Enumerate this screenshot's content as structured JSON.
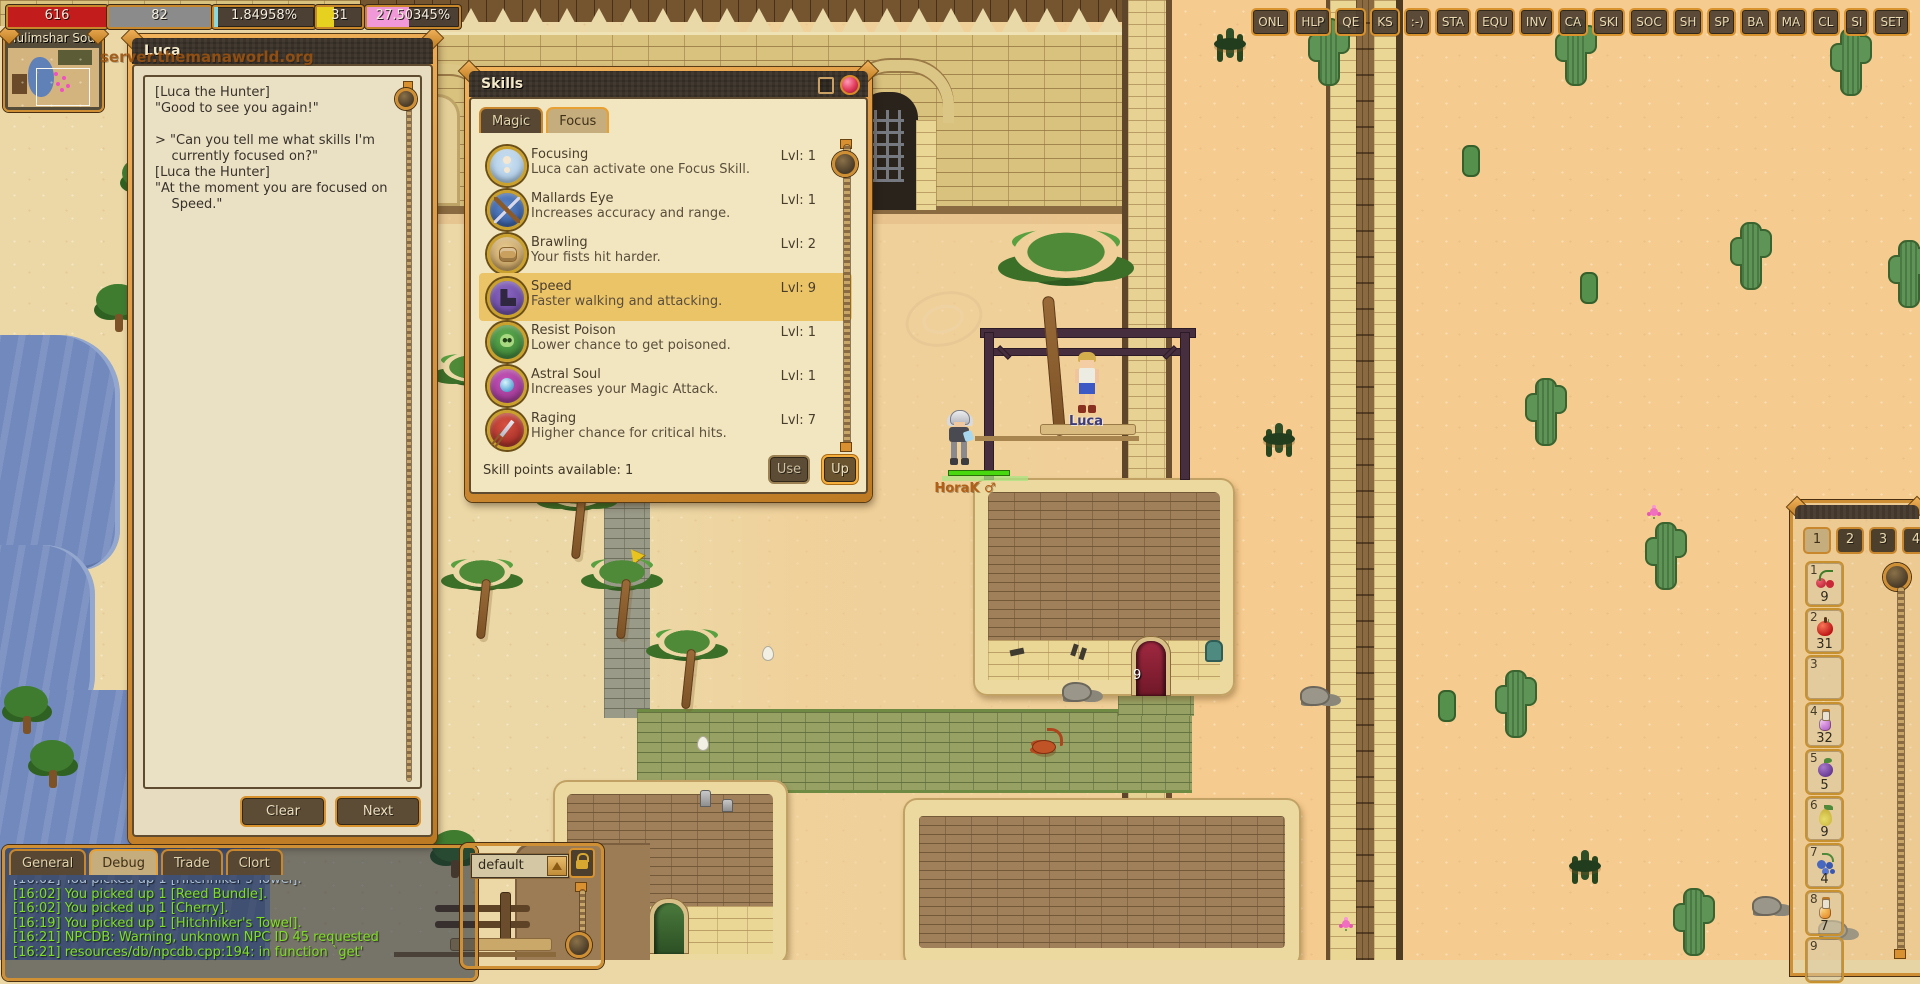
{
  "colors": {
    "accent_orange": "#cf8f35",
    "hp_red": "#c21c1c",
    "mp_gray": "#8b8b8b",
    "exp_cyan": "#8ad8e0",
    "job_yellow": "#e6d020",
    "weight_pink": "#f098d8",
    "chat_green": "#7ede22"
  },
  "status_bars": [
    {
      "id": "hp",
      "text": "616",
      "pct": 100,
      "fill": "#c21c1c"
    },
    {
      "id": "mp",
      "text": "82",
      "pct": 100,
      "fill": "#8b8b8b"
    },
    {
      "id": "exp",
      "text": "1.84958%",
      "pct": 4,
      "fill": "#8ad8e0"
    },
    {
      "id": "job",
      "text": "31",
      "pct": 38,
      "fill": "#e6d020"
    },
    {
      "id": "weight",
      "text": "27.50345%",
      "pct": 46,
      "fill": "#f098d8"
    }
  ],
  "minimap": {
    "title": "Tulimshar Sout"
  },
  "world": {
    "server_text": "server.themanaworld.org",
    "npc_name": "Luca",
    "player_name": "HoraK ♂",
    "door_label": "9"
  },
  "menu_buttons": [
    "ONL",
    "HLP",
    "QE",
    "KS",
    ":-)",
    "STA",
    "EQU",
    "INV",
    "CA",
    "SKI",
    "SOC",
    "SH",
    "SP",
    "BA",
    "MA",
    "CL",
    "SI",
    "SET"
  ],
  "npc_dialog": {
    "title": "Luca",
    "lines": [
      "[Luca the Hunter]",
      "\"Good to see you again!\"",
      "",
      "> \"Can you tell me what skills I'm",
      "    currently focused on?\"",
      "[Luca the Hunter]",
      "\"At the moment you are focused on",
      "    Speed.\""
    ],
    "clear_label": "Clear",
    "next_label": "Next"
  },
  "skills_window": {
    "title": "Skills",
    "tabs": [
      {
        "label": "Magic",
        "selected": false
      },
      {
        "label": "Focus",
        "selected": true
      }
    ],
    "skills": [
      {
        "name": "Focusing",
        "desc": "Luca can activate one Focus Skill.",
        "level": "Lvl: 1",
        "icon": "focusing-icon",
        "selected": false
      },
      {
        "name": "Mallards Eye",
        "desc": "Increases accuracy and range.",
        "level": "Lvl: 1",
        "icon": "mallards-eye-icon",
        "selected": false
      },
      {
        "name": "Brawling",
        "desc": "Your fists hit harder.",
        "level": "Lvl: 2",
        "icon": "brawling-icon",
        "selected": false
      },
      {
        "name": "Speed",
        "desc": "Faster walking and attacking.",
        "level": "Lvl: 9",
        "icon": "speed-icon",
        "selected": true
      },
      {
        "name": "Resist Poison",
        "desc": "Lower chance to get poisoned.",
        "level": "Lvl: 1",
        "icon": "resist-poison-icon",
        "selected": false
      },
      {
        "name": "Astral Soul",
        "desc": "Increases your Magic Attack.",
        "level": "Lvl: 1",
        "icon": "astral-soul-icon",
        "selected": false
      },
      {
        "name": "Raging",
        "desc": "Higher chance for critical hits.",
        "level": "Lvl: 7",
        "icon": "raging-icon",
        "selected": false
      }
    ],
    "footer": "Skill points available: 1",
    "use_label": "Use",
    "up_label": "Up"
  },
  "chat": {
    "tabs": [
      {
        "label": "General",
        "selected": false
      },
      {
        "label": "Debug",
        "selected": true
      },
      {
        "label": "Trade",
        "selected": false
      },
      {
        "label": "Clort",
        "selected": false
      }
    ],
    "messages": [
      {
        "text": "[16:02] You picked up 1 [Hitchhiker's Towel].",
        "old": true
      },
      {
        "text": "[16:02] You picked up 1 [Reed Bundle].",
        "old": false
      },
      {
        "text": "[16:02] You picked up 1 [Cherry].",
        "old": false
      },
      {
        "text": "[16:19] You picked up 1 [Hitchhiker's Towel].",
        "old": false
      },
      {
        "text": "[16:21] NPCDB: Warning, unknown NPC ID 45 requested",
        "old": false
      },
      {
        "text": "[16:21] resources/db/npcdb.cpp:194: in function `get'",
        "old": false
      }
    ]
  },
  "emote_window": {
    "value": "default"
  },
  "shortcut_bar": {
    "tabs": [
      {
        "label": "1",
        "selected": true
      },
      {
        "label": "2",
        "selected": false
      },
      {
        "label": "3",
        "selected": false
      },
      {
        "label": "4",
        "selected": false
      }
    ],
    "slots": [
      {
        "num": "1",
        "item": "cherry",
        "count": "9"
      },
      {
        "num": "2",
        "item": "apple",
        "count": "31"
      },
      {
        "num": "3",
        "item": "",
        "count": ""
      },
      {
        "num": "4",
        "item": "potion-purple",
        "count": "32"
      },
      {
        "num": "5",
        "item": "plum",
        "count": "5"
      },
      {
        "num": "6",
        "item": "pear",
        "count": "9"
      },
      {
        "num": "7",
        "item": "berries",
        "count": "4"
      },
      {
        "num": "8",
        "item": "potion-orange",
        "count": "7"
      },
      {
        "num": "9",
        "item": "",
        "count": ""
      }
    ]
  }
}
